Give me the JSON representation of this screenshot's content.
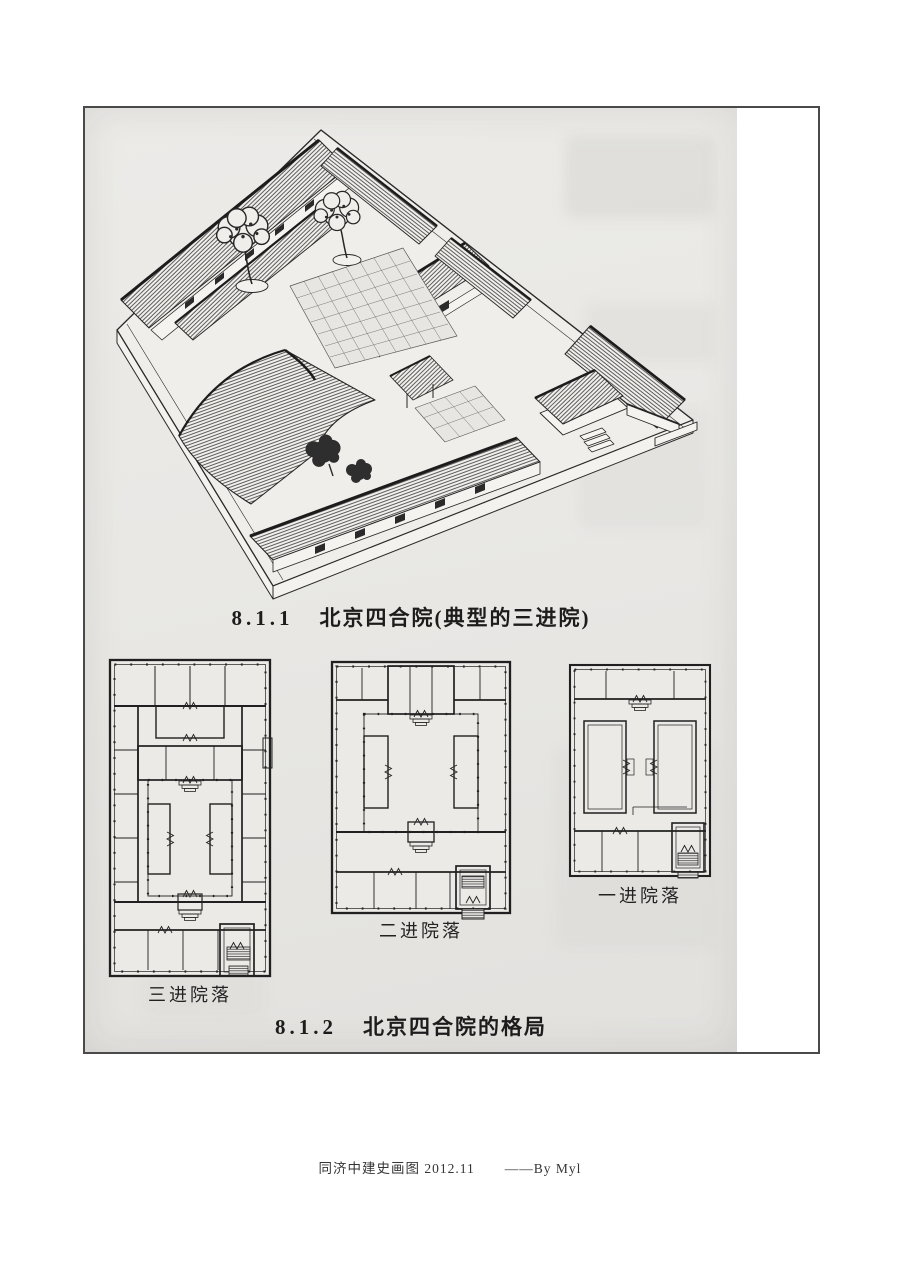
{
  "document": {
    "type": "scanned-textbook-page",
    "ink_color": "#242424",
    "scan_bg": "#e9e8e5",
    "frame_border": "#4a4a4a"
  },
  "figures": {
    "axonometric": {
      "caption_no": "8.1.1",
      "caption_text": "北京四合院(典型的三进院)"
    },
    "plans": [
      {
        "label": "三进院落"
      },
      {
        "label": "二进院落"
      },
      {
        "label": "一进院落"
      }
    ],
    "layout_caption": {
      "caption_no": "8.1.2",
      "caption_text": "北京四合院的格局"
    }
  },
  "footer": {
    "text": "同济中建史画图 2012.11",
    "byline": "——By Myl"
  }
}
